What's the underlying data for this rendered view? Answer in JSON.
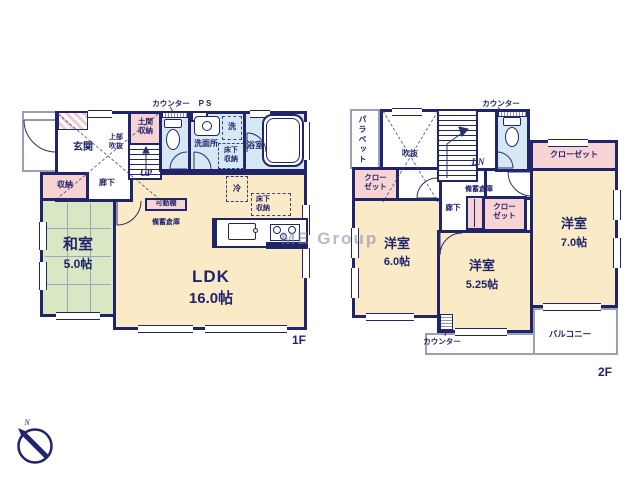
{
  "colors": {
    "wall": "#20246b",
    "room_cream": "#faeac6",
    "tatami_green": "#d9e7c2",
    "storage_pink": "#f8d3d3",
    "wet_blue": "#d5e8f4",
    "background": "#ffffff"
  },
  "watermark": "ME Group",
  "compass": {
    "north": "N"
  },
  "f1": {
    "floor": "1F",
    "counter": "カウンター",
    "ps": "PS",
    "genkan": "玄関",
    "doma": "土間収納",
    "upper_void": "上部吹抜",
    "up": "UP",
    "washroom": "洗面所",
    "laundry": "洗",
    "bath": "浴室",
    "underfloor_a": "床下収納",
    "underfloor_b": "床下収納",
    "hall": "廊下",
    "storage": "収納",
    "washitsu": "和室",
    "washitsu_size": "5.0帖",
    "shelf": "可動棚",
    "stockpile": "備蓄倉庫",
    "fridge": "冷",
    "ldk": "LDK",
    "ldk_size": "16.0帖"
  },
  "f2": {
    "floor": "2F",
    "parapet": "パラペット",
    "void": "吹抜",
    "dn": "DN",
    "counter_top": "カウンター",
    "counter_bottom": "カウンター",
    "closet_a": "クローゼット",
    "closet_b": "クローゼット",
    "closet_c": "クローゼット",
    "stockpile": "備蓄倉庫",
    "hall": "廊下",
    "room_a": "洋室",
    "room_a_size": "6.0帖",
    "room_b": "洋室",
    "room_b_size": "5.25帖",
    "room_c": "洋室",
    "room_c_size": "7.0帖",
    "balcony": "バルコニー"
  }
}
